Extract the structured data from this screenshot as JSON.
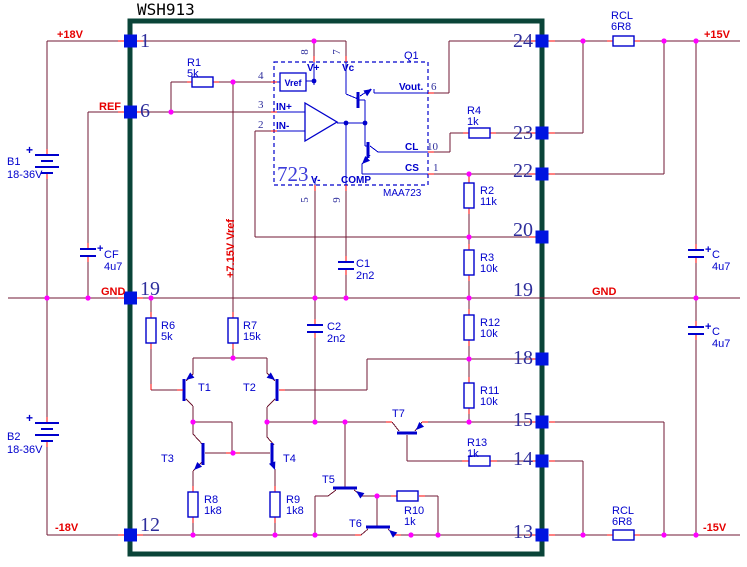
{
  "title": "WSH913",
  "colors": {
    "wire": "#701A34",
    "red": "#FF0000",
    "blue": "#0000CC",
    "pad": "#0014E0",
    "dot": "#FF00FF",
    "border": "#0A4438",
    "pin_number": "#2E2E9C",
    "net_label": "#E60000",
    "component_label": "#0000CD",
    "ic_big": "#3C3CD9",
    "title_text": "#000000"
  },
  "nets": [
    {
      "text": "+18V",
      "x": 57,
      "y": 38,
      "rotate": 0
    },
    {
      "text": "REF",
      "x": 99,
      "y": 110,
      "rotate": 0
    },
    {
      "text": "GND",
      "x": 101,
      "y": 295,
      "rotate": 0
    },
    {
      "text": "GND",
      "x": 592,
      "y": 295,
      "rotate": 0
    },
    {
      "text": "-18V",
      "x": 55,
      "y": 531,
      "rotate": 0
    },
    {
      "text": "+15V",
      "x": 704,
      "y": 38,
      "rotate": 0
    },
    {
      "text": "-15V",
      "x": 703,
      "y": 531,
      "rotate": 0
    },
    {
      "text": "+7.15V Vref",
      "x": 234,
      "y": 278,
      "rotate": -90
    }
  ],
  "pins": {
    "left": [
      {
        "num": "1",
        "row": 41,
        "nx": 140,
        "ny": 47
      },
      {
        "num": "6",
        "row": 112,
        "nx": 140,
        "ny": 117
      },
      {
        "num": "19",
        "row": 298,
        "nx": 140,
        "ny": 295
      },
      {
        "num": "12",
        "row": 535,
        "nx": 140,
        "ny": 531
      }
    ],
    "right": [
      {
        "num": "24",
        "row": 41,
        "nx": 533,
        "ny": 47
      },
      {
        "num": "23",
        "row": 133,
        "nx": 533,
        "ny": 139
      },
      {
        "num": "22",
        "row": 174,
        "nx": 533,
        "ny": 177
      },
      {
        "num": "20",
        "row": 237,
        "nx": 533,
        "ny": 236
      },
      {
        "num": "18",
        "row": 359,
        "nx": 533,
        "ny": 364
      },
      {
        "num": "15",
        "row": 422,
        "nx": 533,
        "ny": 426
      },
      {
        "num": "14",
        "row": 461,
        "nx": 533,
        "ny": 465
      },
      {
        "num": "13",
        "row": 535,
        "nx": 533,
        "ny": 538
      }
    ],
    "right_no_pad": [
      {
        "num": "19",
        "nx": 533,
        "ny": 296
      }
    ]
  },
  "resistors": [
    {
      "ref": "R1",
      "value": "5k",
      "orient": "h",
      "bx": 192,
      "by": 77,
      "lx": 187,
      "ly": 66
    },
    {
      "ref": "RCL",
      "value": "6R8",
      "orient": "h",
      "bx": 613,
      "by": 36,
      "lx": 611,
      "ly": 19
    },
    {
      "ref": "RCL",
      "value": "6R8",
      "orient": "h",
      "bx": 613,
      "by": 530,
      "lx": 612,
      "ly": 514
    },
    {
      "ref": "R4",
      "value": "1k",
      "orient": "h",
      "bx": 469,
      "by": 128,
      "lx": 467,
      "ly": 114
    },
    {
      "ref": "R13",
      "value": "1k",
      "orient": "h",
      "bx": 469,
      "by": 456,
      "lx": 467,
      "ly": 446
    },
    {
      "ref": "R10",
      "value": "1k",
      "orient": "h",
      "bx": 397,
      "by": 491,
      "lx": 404,
      "ly": 514
    },
    {
      "ref": "R2",
      "value": "11k",
      "orient": "v",
      "bx": 464,
      "by": 183,
      "lx": 480,
      "ly": 194
    },
    {
      "ref": "R3",
      "value": "10k",
      "orient": "v",
      "bx": 464,
      "by": 250,
      "lx": 480,
      "ly": 261
    },
    {
      "ref": "R12",
      "value": "10k",
      "orient": "v",
      "bx": 464,
      "by": 315,
      "lx": 480,
      "ly": 326
    },
    {
      "ref": "R11",
      "value": "10k",
      "orient": "v",
      "bx": 464,
      "by": 383,
      "lx": 480,
      "ly": 394
    },
    {
      "ref": "R6",
      "value": "5k",
      "orient": "v",
      "bx": 146,
      "by": 318,
      "lx": 161,
      "ly": 329
    },
    {
      "ref": "R7",
      "value": "15k",
      "orient": "v",
      "bx": 228,
      "by": 318,
      "lx": 243,
      "ly": 329
    },
    {
      "ref": "R8",
      "value": "1k8",
      "orient": "v",
      "bx": 188,
      "by": 492,
      "lx": 204,
      "ly": 503
    },
    {
      "ref": "R9",
      "value": "1k8",
      "orient": "v",
      "bx": 270,
      "by": 492,
      "lx": 286,
      "ly": 503
    }
  ],
  "capacitors": [
    {
      "ref": "C1",
      "value": "2n2",
      "x": 346,
      "y": 262,
      "polar": false,
      "lx": 356,
      "ly": 267
    },
    {
      "ref": "C2",
      "value": "2n2",
      "x": 315,
      "y": 325,
      "polar": false,
      "lx": 327,
      "ly": 330
    },
    {
      "ref": "CF",
      "value": "4u7",
      "x": 88,
      "y": 249,
      "polar": true,
      "lx": 104,
      "ly": 258
    },
    {
      "ref": "C",
      "value": "4u7",
      "x": 696,
      "y": 250,
      "polar": true,
      "lx": 712,
      "ly": 258
    },
    {
      "ref": "C",
      "value": "4u7",
      "x": 696,
      "y": 327,
      "polar": true,
      "lx": 712,
      "ly": 335
    }
  ],
  "batteries": [
    {
      "ref": "B1",
      "value": "18-36V",
      "x": 47,
      "y": 155,
      "lx": 7,
      "ly": 165
    },
    {
      "ref": "B2",
      "value": "18-36V",
      "x": 47,
      "y": 423,
      "lx": 7,
      "ly": 440
    }
  ],
  "transistors": [
    {
      "ref": "T1",
      "lx": 198,
      "ly": 391
    },
    {
      "ref": "T2",
      "lx": 243,
      "ly": 391
    },
    {
      "ref": "T3",
      "lx": 161,
      "ly": 462
    },
    {
      "ref": "T4",
      "lx": 283,
      "ly": 462
    },
    {
      "ref": "T5",
      "lx": 322,
      "ly": 483
    },
    {
      "ref": "T6",
      "lx": 349,
      "ly": 527
    },
    {
      "ref": "T7",
      "lx": 392,
      "ly": 417
    },
    {
      "ref": "Q1",
      "lx": 404,
      "ly": 59
    }
  ],
  "ic": {
    "big": "723",
    "big_x": 277,
    "big_y": 181,
    "part": "MAA723",
    "part_x": 383,
    "part_y": 196,
    "vref_box_label": "Vref",
    "labels": [
      [
        "V+",
        307,
        71
      ],
      [
        "Vc",
        342,
        71
      ],
      [
        "IN+",
        276,
        110
      ],
      [
        "IN-",
        276,
        129
      ],
      [
        "V-",
        311,
        183
      ],
      [
        "COMP",
        341,
        183
      ],
      [
        "Vout.",
        399,
        90
      ],
      [
        "CL",
        405,
        150
      ],
      [
        "CS",
        405,
        171
      ]
    ],
    "nums": [
      [
        "4",
        258,
        79,
        0
      ],
      [
        "3",
        258,
        108,
        0
      ],
      [
        "2",
        258,
        128,
        0
      ],
      [
        "6",
        431,
        90,
        0
      ],
      [
        "10",
        427,
        150,
        0
      ],
      [
        "1",
        433,
        171,
        0
      ],
      [
        "8",
        308,
        52,
        -90
      ],
      [
        "7",
        340,
        52,
        -90
      ],
      [
        "5",
        308,
        200,
        -90
      ],
      [
        "9",
        340,
        200,
        -90
      ]
    ]
  }
}
